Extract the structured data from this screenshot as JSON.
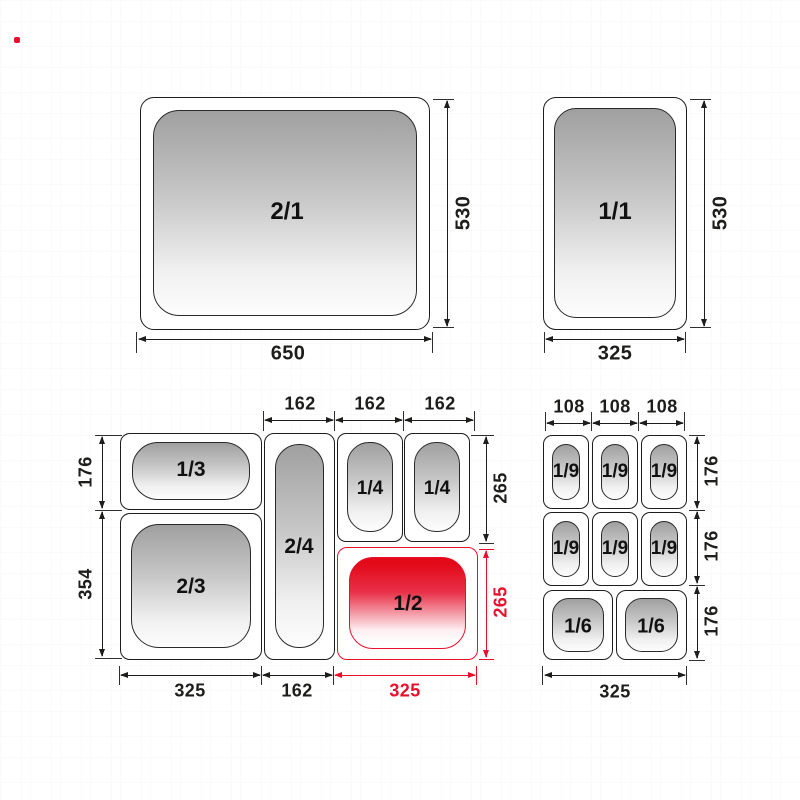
{
  "colors": {
    "accent_red": "#e8112d",
    "line_black": "#1d1d1b",
    "pan_gradient_top": "#a0a0a0",
    "pan_gradient_bottom": "#fdfdfd"
  },
  "gn21": {
    "label": "2/1",
    "width_dim": "650",
    "height_dim": "530"
  },
  "gn11": {
    "label": "1/1",
    "width_dim": "325",
    "height_dim": "530"
  },
  "bl": {
    "p13": "1/3",
    "p24": "2/4",
    "p14a": "1/4",
    "p14b": "1/4",
    "p23": "2/3",
    "p12": "1/2",
    "top_dims": [
      "162",
      "162",
      "162"
    ],
    "left_dims": [
      "176",
      "354"
    ],
    "right_dims": [
      "265",
      "265"
    ],
    "bottom_dims": [
      "325",
      "162",
      "325"
    ]
  },
  "br": {
    "p19": [
      "1/9",
      "1/9",
      "1/9",
      "1/9",
      "1/9",
      "1/9"
    ],
    "p16": [
      "1/6",
      "1/6"
    ],
    "top_dims": [
      "108",
      "108",
      "108"
    ],
    "right_dims": [
      "176",
      "176",
      "176"
    ],
    "bottom_dim": "325"
  }
}
